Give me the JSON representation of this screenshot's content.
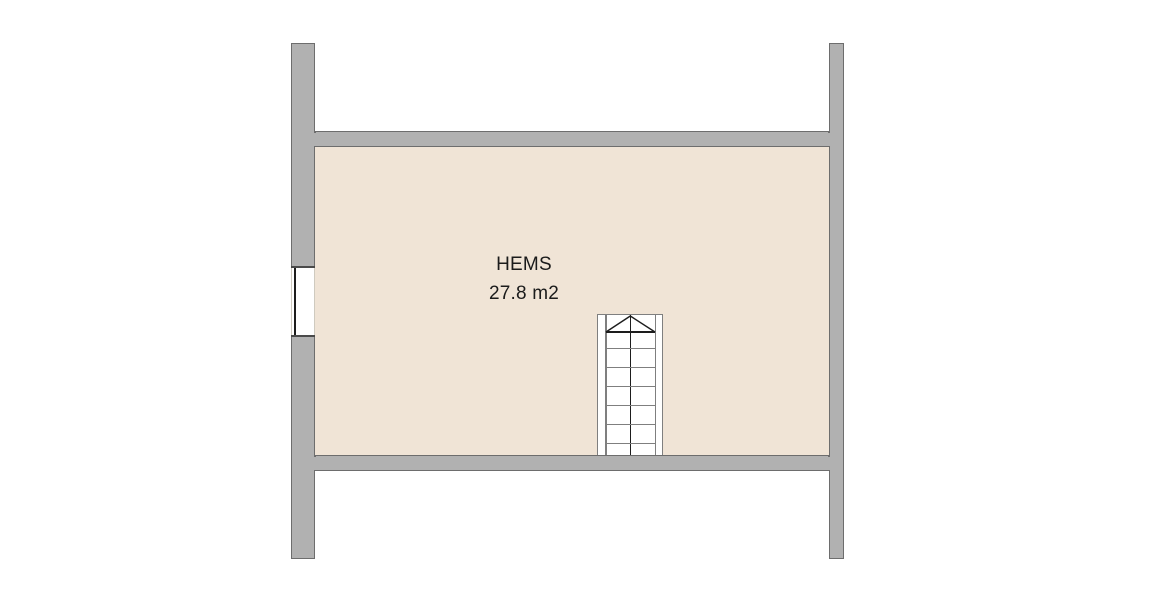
{
  "room": {
    "name": "HEMS",
    "area": "27.8 m2"
  },
  "staircase": {
    "treads": 6,
    "direction_arrow": "up"
  },
  "colors": {
    "background": "#ffffff",
    "wall_fill": "#b1b1b1",
    "wall_outline": "#6d6d6d",
    "floor_fill": "#f0e4d6",
    "window_jamb": "#4a4a4a",
    "stair_line": "#7f7f7f",
    "accent_line": "#1d1d1d",
    "text": "#1b1b1b"
  }
}
